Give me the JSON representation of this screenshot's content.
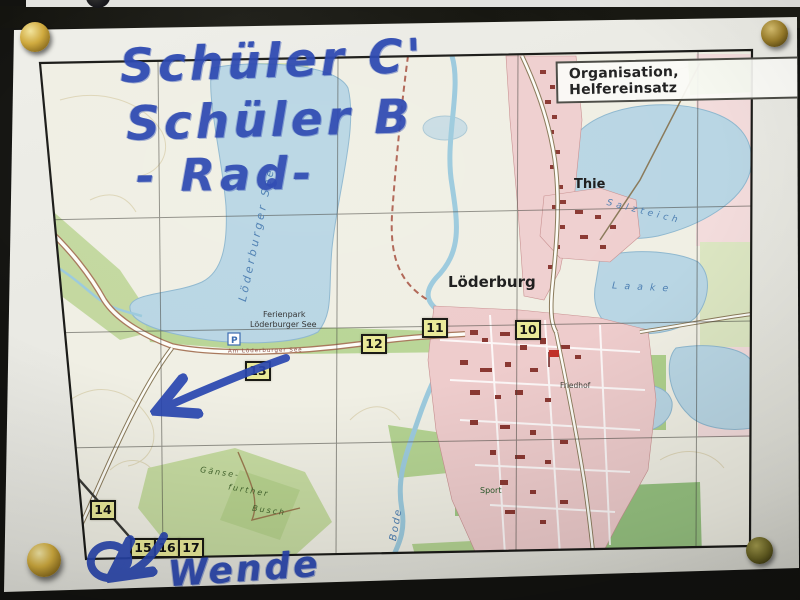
{
  "scene": {
    "board_color": "#131310",
    "paper_color": "#e9e9e3"
  },
  "handwriting": {
    "color": "#2946b0",
    "line1": "Schüler C'",
    "line2": "Schüler B",
    "line3": "- Rad-",
    "turn_note": "Wende"
  },
  "map": {
    "legend_box_label": "Organisation, Helfereinsatz",
    "labels": {
      "town_main": "Löderburg",
      "town_small": "Thie",
      "lake_main": "Löderburger See",
      "lake_salzteich": "Salzteich",
      "lake_laake": "Laake",
      "river_bode": "Bode",
      "ferienpark_line1": "Ferienpark",
      "ferienpark_line2": "Löderburger See",
      "street_small": "Am Löderburger See",
      "cemetery": "Friedhof",
      "sports_field": "Sport",
      "forest_part1": "Gänse-",
      "forest_part2": "further",
      "forest_part3": "Busch",
      "parking_symbol": "P"
    },
    "checkpoints": [
      {
        "number": "10"
      },
      {
        "number": "11"
      },
      {
        "number": "12"
      },
      {
        "number": "13"
      },
      {
        "number": "14"
      },
      {
        "number": "15"
      },
      {
        "number": "16"
      },
      {
        "number": "17"
      }
    ],
    "colors": {
      "water": "#b9d6e4",
      "forest": "#c6dba1",
      "settlement": "#efcfcf",
      "checkpoint_bg": "#e9e998"
    }
  }
}
